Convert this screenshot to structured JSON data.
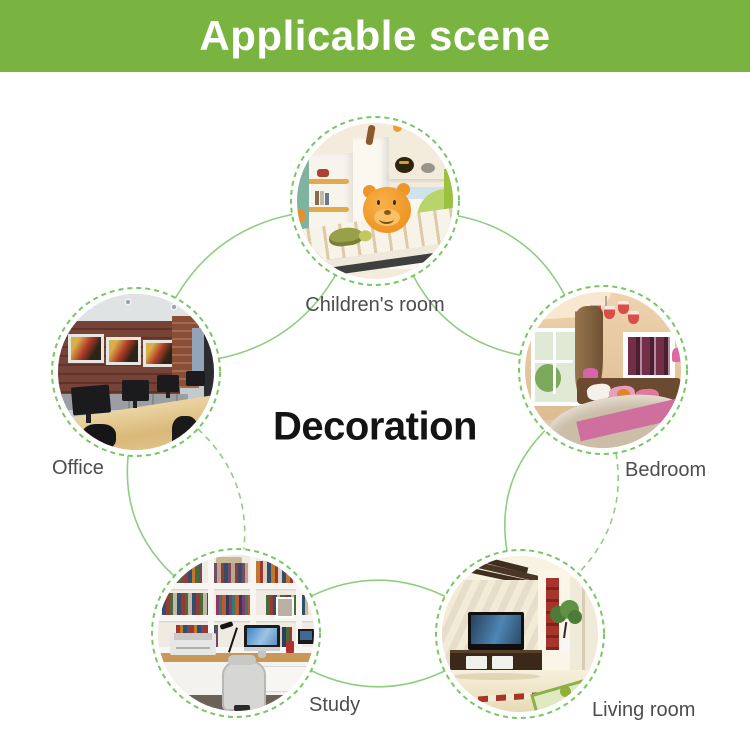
{
  "header": {
    "title": "Applicable scene",
    "bg_color": "#79b440",
    "text_color": "#ffffff"
  },
  "center": {
    "title": "Decoration",
    "color": "#141414"
  },
  "diagram": {
    "line_color": "#8fce80",
    "ring_color": "#78c765",
    "label_color": "#4d4d4d",
    "items": [
      {
        "id": "children-room",
        "label": "Children's room",
        "photo": "children-room-with-plush-bear"
      },
      {
        "id": "bedroom",
        "label": "Bedroom",
        "photo": "bedroom-with-pink-accents"
      },
      {
        "id": "office",
        "label": "Office",
        "photo": "office-with-monitors"
      },
      {
        "id": "study",
        "label": "Study",
        "photo": "study-with-bookshelves"
      },
      {
        "id": "living-room",
        "label": "Living room",
        "photo": "living-room-with-tv"
      }
    ]
  }
}
